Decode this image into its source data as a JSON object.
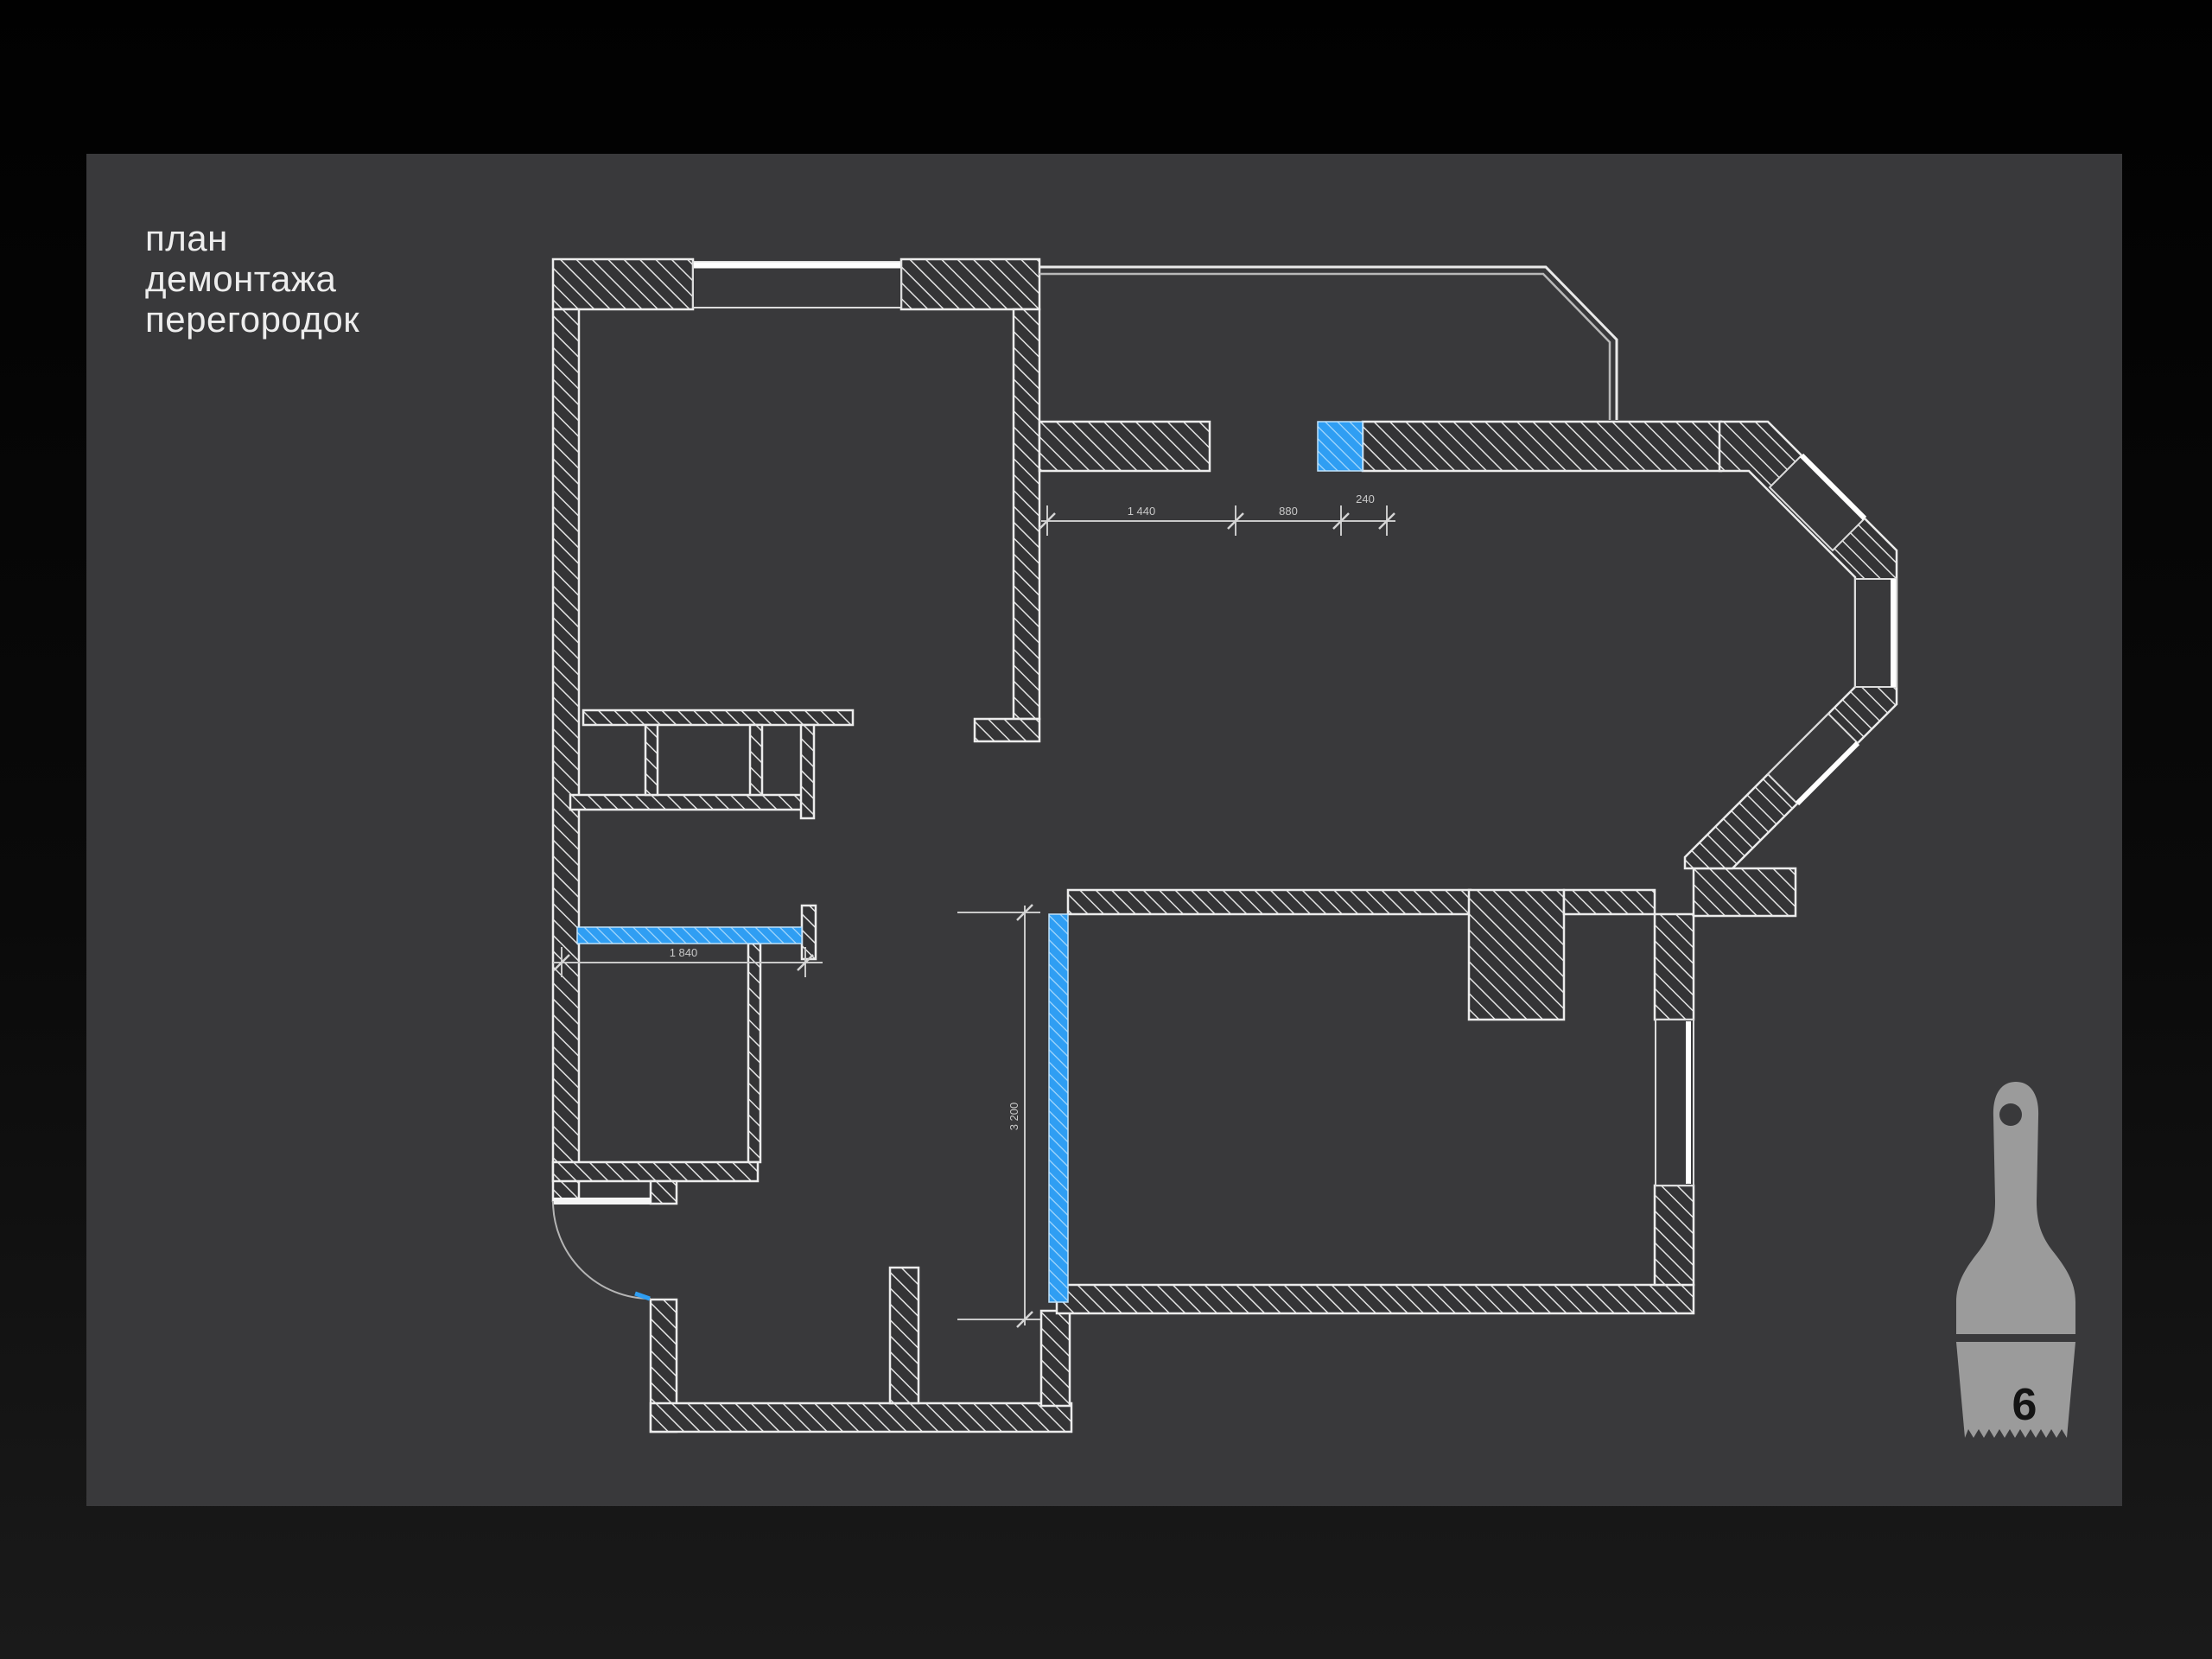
{
  "slide": {
    "title_lines": [
      "план",
      "демонтажа",
      "перегородок"
    ],
    "page_number": "6"
  },
  "plan": {
    "dimensions": {
      "top": [
        "1 440",
        "880",
        "240"
      ],
      "closet_width": "1 840",
      "partition_height": "3 200"
    },
    "highlight_meaning": "partition-to-demolish"
  },
  "colors": {
    "page_background": "#060606",
    "panel_background": "#39393b",
    "wall_fill": "#343436",
    "wall_outline": "#ececec",
    "hatch_line": "#e3e3e3",
    "demolition_highlight": "#2f9ef3",
    "demolition_hatch_line": "#a8d9fc",
    "dimension_line": "#c9c9c9",
    "title_text": "#ededed",
    "brush_gray": "#9b9b9b",
    "brush_number": "#141414"
  }
}
